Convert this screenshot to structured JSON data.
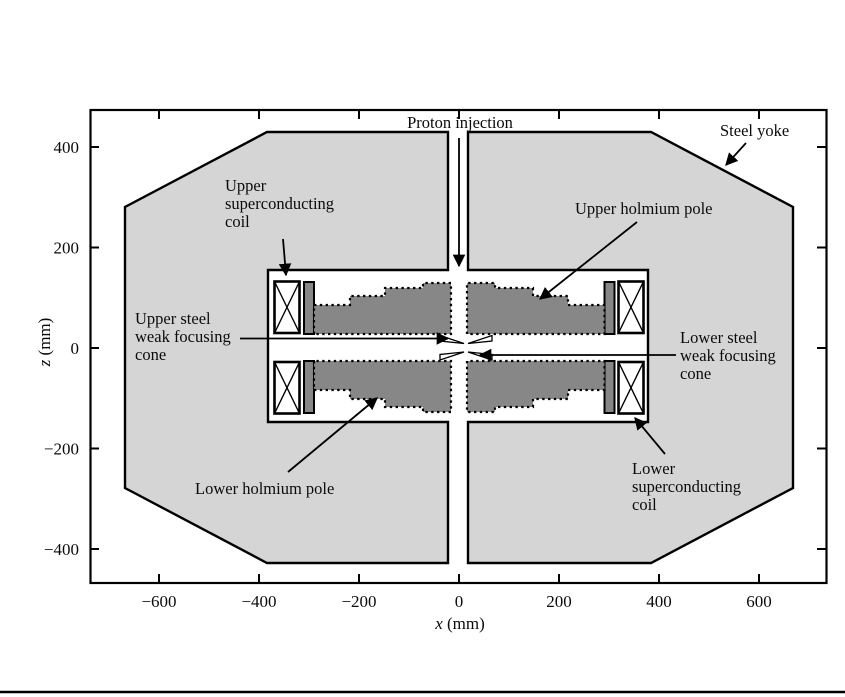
{
  "figure": {
    "labels": {
      "proton_injection": "Proton injection",
      "steel_yoke": "Steel yoke",
      "upper_sc_coil_lines": [
        "Upper",
        "superconducting",
        "coil"
      ],
      "upper_holmium_pole": "Upper holmium pole",
      "upper_cone_lines": [
        "Upper steel",
        "weak focusing",
        "cone"
      ],
      "lower_cone_lines": [
        "Lower steel",
        "weak focusing",
        "cone"
      ],
      "lower_holmium_pole": "Lower holmium pole",
      "lower_sc_coil_lines": [
        "Lower",
        "superconducting",
        "coil"
      ]
    },
    "x_axis": {
      "variable": "x",
      "unit": " (mm)",
      "ticks": [
        "−600",
        "−400",
        "−200",
        "0",
        "200",
        "400",
        "600"
      ]
    },
    "z_axis": {
      "variable": "z",
      "unit": " (mm)",
      "ticks": [
        "400",
        "200",
        "0",
        "−200",
        "−400"
      ]
    },
    "colors": {
      "yoke_fill": "#d5d5d5",
      "pole_fill": "#878787",
      "outline": "#000000",
      "background": "#ffffff"
    },
    "geometry_mm": {
      "axes_range": {
        "x": [
          -738,
          734
        ],
        "z": [
          -467,
          473
        ]
      },
      "steel_yoke": {
        "type": "octagon",
        "x_extent": [
          -668,
          668
        ],
        "z_extent": [
          -430,
          432
        ]
      },
      "injection_channel_x": [
        -20,
        18
      ],
      "inner_cavity": {
        "x": [
          -382,
          378
        ],
        "z": [
          -148,
          156
        ]
      },
      "superconducting_coils": {
        "abs_x": [
          318,
          370
        ],
        "abs_z": [
          28,
          134
        ]
      },
      "holmium_poles": {
        "abs_x": [
          16,
          292
        ],
        "abs_z": [
          28,
          130
        ],
        "profile": "stepped toward midplane"
      },
      "weak_focusing_cones_abs_z": [
        2,
        12
      ]
    }
  }
}
